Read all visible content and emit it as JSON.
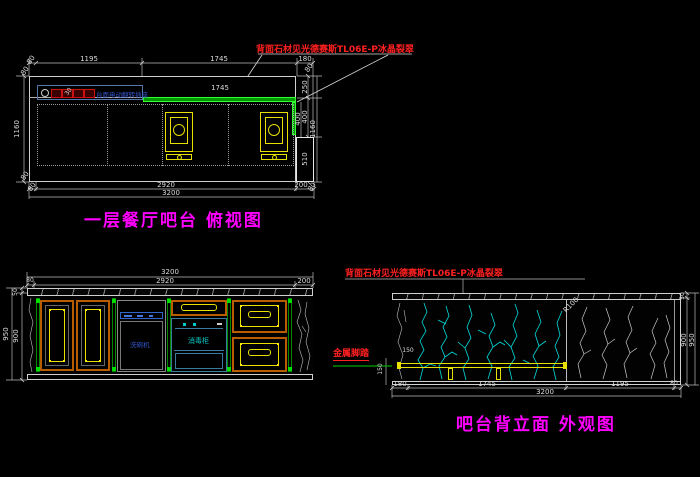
{
  "colors": {
    "background": "#000000",
    "line_white": "#d0d0d0",
    "title_magenta": "#ff00ff",
    "note_red": "#ff2020",
    "stone_green": "#00b400",
    "fixture_yellow": "#e8e000",
    "cabinet_orange": "#b85c00",
    "marble_vein_cyan": "#00dcdc",
    "marble_vein_gray": "#c8c8c8",
    "appliance_blue": "#3355cc",
    "sterilizer_cyan": "#00c8c8"
  },
  "plan": {
    "title": "一层餐厅吧台 俯视图",
    "note": "背面石材见光德赛斯TL06E-P冰晶裂翠",
    "socket_label": "台面电动翻转插座",
    "dims": {
      "top_chain": [
        "80",
        "1195",
        "1745",
        "180"
      ],
      "corner_80": "80",
      "inner_width": "1745",
      "left_height": "1160",
      "left_small": "30",
      "stone_depth": "400",
      "right_chain": [
        "250",
        "400",
        "510"
      ],
      "right_height": "1160",
      "bottom_chain": [
        "80",
        "2920",
        "200",
        "80"
      ],
      "bottom_total": "3200"
    }
  },
  "front": {
    "dims": {
      "top_total": "3200",
      "top_chain": [
        "80",
        "2920",
        "200"
      ],
      "left_chain": [
        "50",
        "900"
      ],
      "left_total": "950"
    },
    "labels": {
      "dishwasher": "洗碗机",
      "sterilizer": "消毒柜"
    }
  },
  "back": {
    "title": "吧台背立面 外观图",
    "note": "背面石材见光德赛斯TL06E-P冰晶裂翠",
    "footrest_label": "金属脚踏",
    "radius_label": "R100",
    "dims": {
      "bottom_chain": [
        "180",
        "1745",
        "1195",
        "80"
      ],
      "bottom_total": "3200",
      "right_chain": [
        "50",
        "900"
      ],
      "right_total": "950",
      "footrest_height": "150",
      "footrest_inset": "150"
    }
  }
}
